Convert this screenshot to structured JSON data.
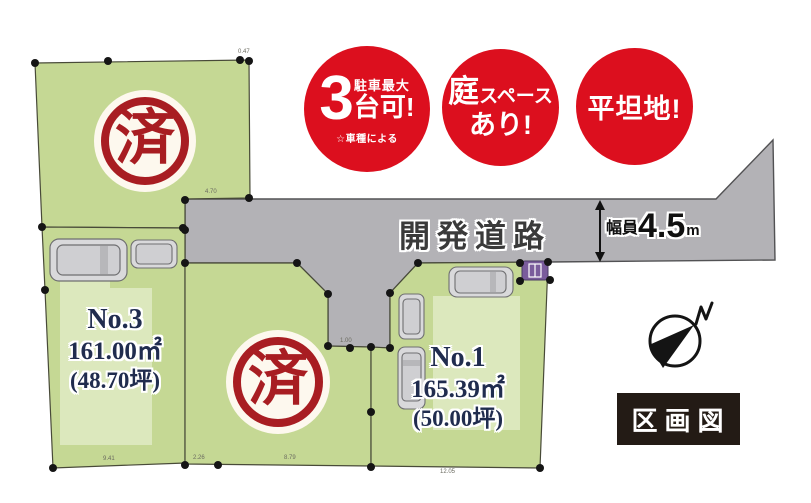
{
  "title": "区画図",
  "badges": [
    {
      "big": "3",
      "top": "駐車最大",
      "mid": "台可!",
      "note": "☆車種による"
    },
    {
      "line1_big": "庭",
      "line1_rest": "スペース",
      "line2": "あり!"
    },
    {
      "text": "平坦地!"
    }
  ],
  "road": {
    "label": "開発道路",
    "width_prefix": "幅員",
    "width_value": "4.5",
    "width_unit": "m"
  },
  "lots": [
    {
      "id": "No.3",
      "area_m2": "161.00㎡",
      "area_tsubo": "(48.70坪)"
    },
    {
      "id": "No.1",
      "area_m2": "165.39㎡",
      "area_tsubo": "(50.00坪)"
    }
  ],
  "stamps": {
    "sold": "済"
  },
  "compass": {
    "north": "N"
  },
  "legend": {
    "title": "区画図"
  },
  "dims": [
    "0.47",
    "4.70",
    "9.41",
    "2.26",
    "8.79",
    "12.05",
    "1.00"
  ],
  "colors": {
    "badge_red": "#dc0f1e",
    "stamp_red": "#a81d22",
    "lot_green": "#c5d894",
    "footprint_green": "#dce8bd",
    "road_gray": "#b3b2b6",
    "label_navy": "#202c4e",
    "legend_black": "#231b15",
    "marker_purple": "#7a5c9c"
  }
}
